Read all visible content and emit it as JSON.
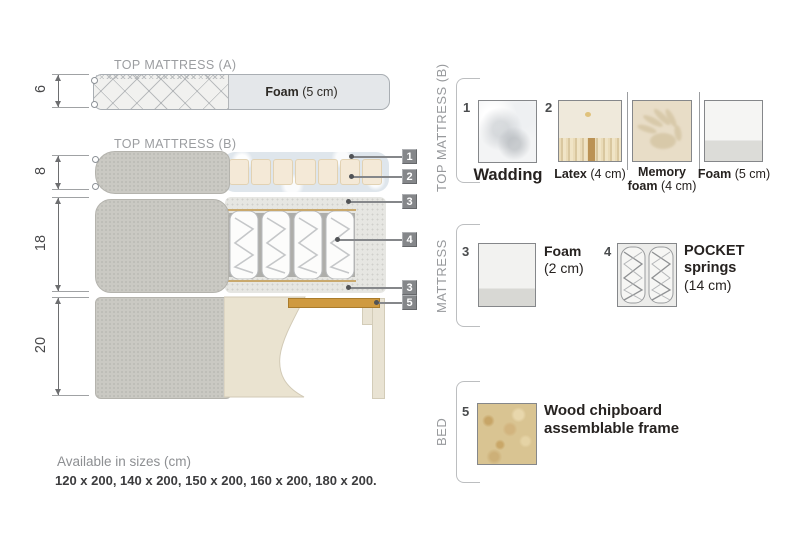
{
  "diagram": {
    "top_a": {
      "title": "TOP MATTRESS (A)",
      "foam_bold": "Foam",
      "foam_rest": " (5 cm)"
    },
    "top_b": {
      "title": "TOP MATTRESS (B)"
    },
    "dimensions": [
      {
        "value": "6"
      },
      {
        "value": "8"
      },
      {
        "value": "18"
      },
      {
        "value": "20"
      }
    ],
    "tags": [
      {
        "n": "1"
      },
      {
        "n": "2"
      },
      {
        "n": "3"
      },
      {
        "n": "4"
      },
      {
        "n": "3"
      },
      {
        "n": "5"
      }
    ]
  },
  "legend": {
    "sections": [
      {
        "label": "TOP MATTRESS (B)"
      },
      {
        "label": "MATTRESS"
      },
      {
        "label": "BED"
      }
    ],
    "wadding": {
      "num": "1",
      "label": "Wadding"
    },
    "latex": {
      "num": "2",
      "bold": "Latex",
      "rest": " (4 cm)"
    },
    "memory": {
      "bold1": "Memory",
      "bold2": "foam",
      "rest": " (4 cm)"
    },
    "foam5": {
      "bold": "Foam",
      "rest": " (5 cm)"
    },
    "foam2": {
      "num": "3",
      "bold": "Foam",
      "rest": "(2 cm)"
    },
    "pocket": {
      "num": "4",
      "bold1": "POCKET",
      "bold2": "springs",
      "rest": "(14 cm)"
    },
    "wood": {
      "num": "5",
      "line1": "Wood chipboard",
      "line2": "assemblable frame"
    }
  },
  "footer": {
    "title": "Available in sizes (cm)",
    "sizes": "120 x 200, 140 x 200, 150 x 200, 160 x 200, 180 x 200."
  },
  "colors": {
    "fabric_gray": "#cac9c3",
    "foam_cream": "#f4e9d7",
    "wadding_blue": "#dfe6ec",
    "wood_slat": "#cf9a40",
    "chipboard": "#d9c492",
    "tag_gray": "#85878a",
    "text_dark": "#2d2a26",
    "text_gray": "#97999c"
  }
}
